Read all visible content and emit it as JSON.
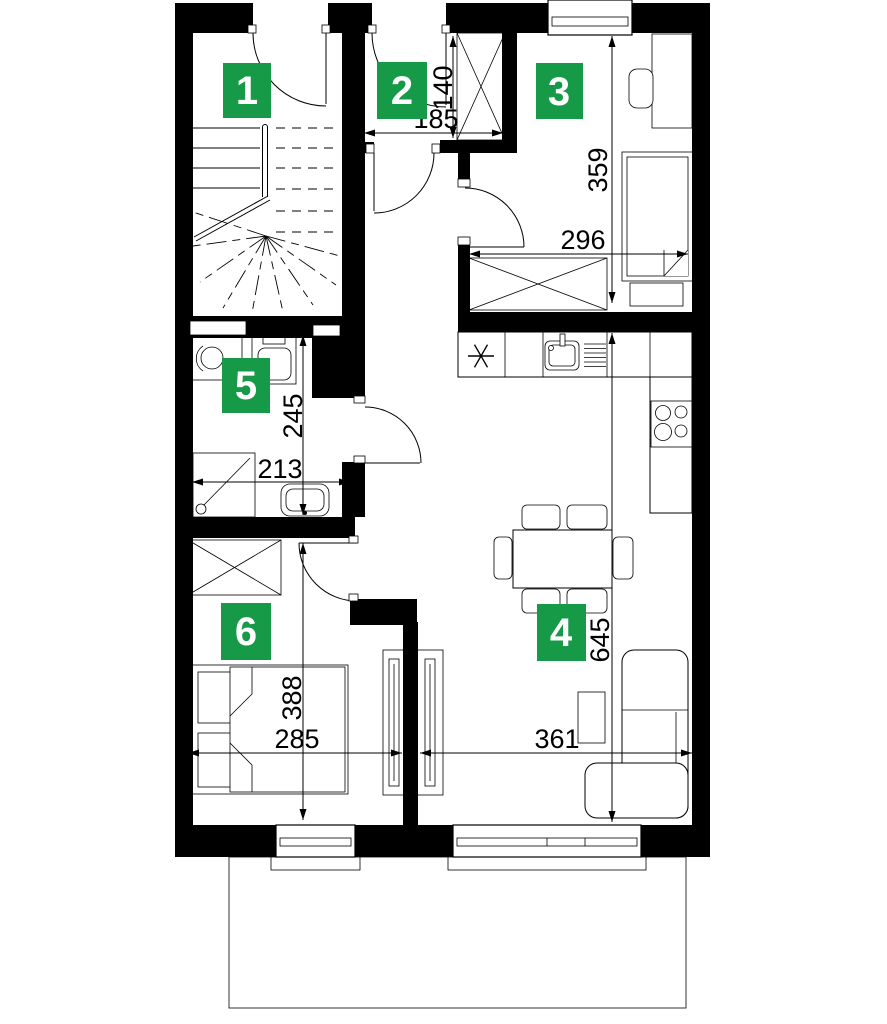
{
  "plan": {
    "colors": {
      "wall": "#000000",
      "label_green": "#169a47",
      "label_text": "#ffffff"
    },
    "room_labels": [
      "1",
      "2",
      "3",
      "4",
      "5",
      "6"
    ],
    "dimensions_cm": {
      "hall_closet_depth": "140",
      "hall_width": "185",
      "room3_height": "359",
      "room3_width": "296",
      "bath_height": "245",
      "bath_width": "213",
      "room6_height": "388",
      "room6_width": "285",
      "living_width": "361",
      "living_height": "645"
    }
  }
}
